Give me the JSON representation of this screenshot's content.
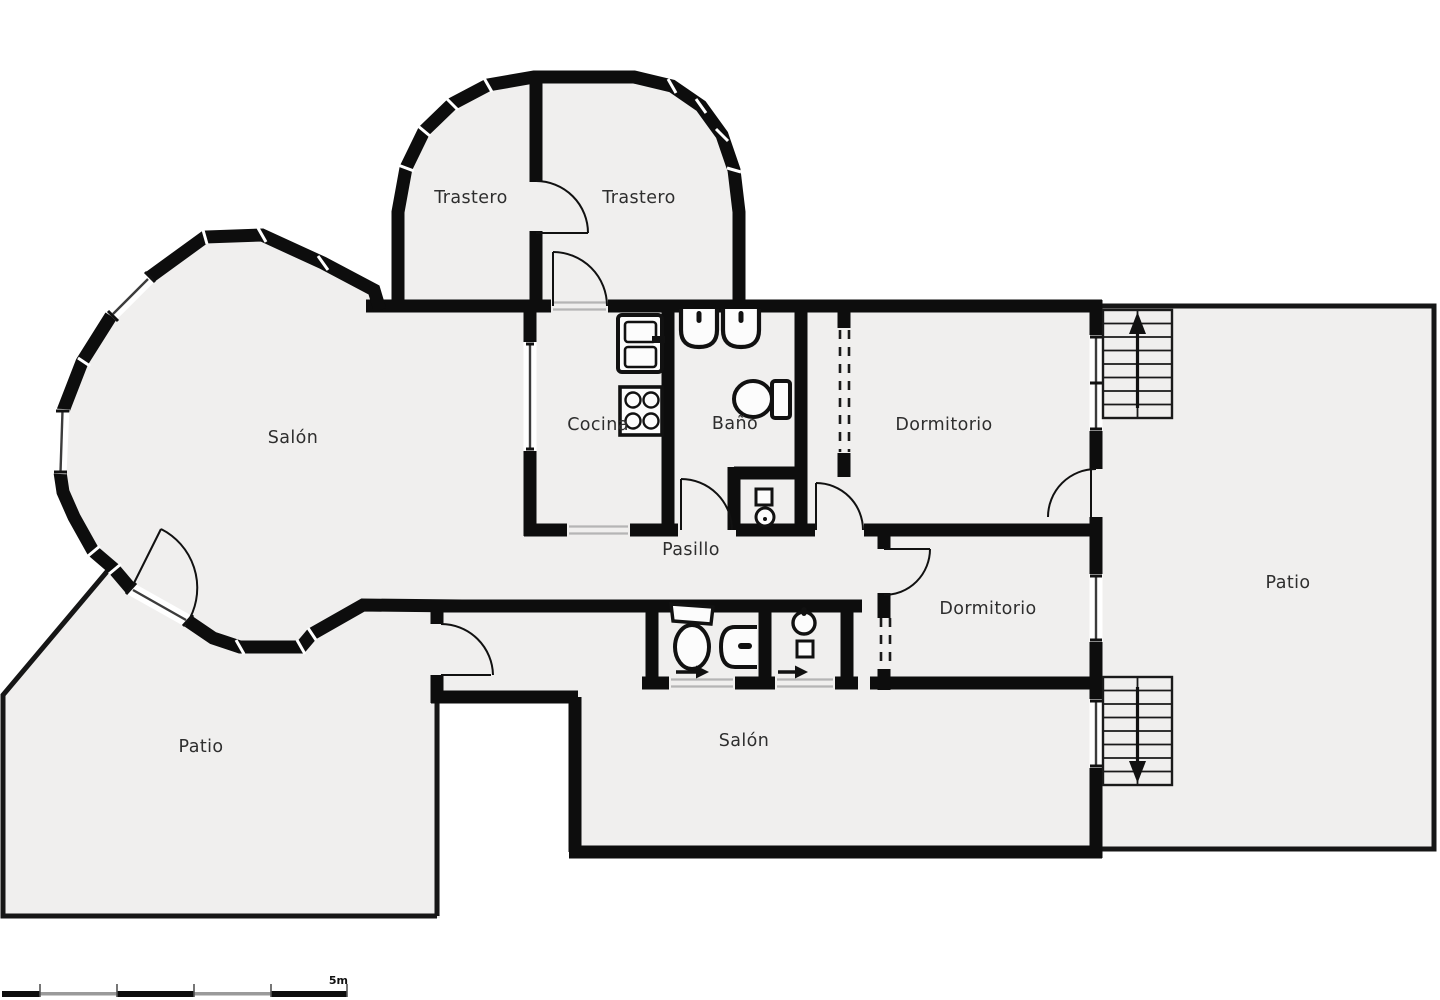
{
  "title": "Floor plan",
  "colors": {
    "wall": "#0d0d0d",
    "thin_wall": "#161616",
    "floor": "#f0efee",
    "outside": "#ffffff",
    "threshold": "#b5b5b5",
    "label": "#2e2e2e",
    "scale_gray": "#9a9a9a"
  },
  "rooms": [
    {
      "id": "trastero-left",
      "label": "Trastero"
    },
    {
      "id": "trastero-right",
      "label": "Trastero"
    },
    {
      "id": "salon-left",
      "label": "Salón"
    },
    {
      "id": "cocina",
      "label": "Cocina"
    },
    {
      "id": "bano",
      "label": "Baño"
    },
    {
      "id": "dormitorio-1",
      "label": "Dormitorio"
    },
    {
      "id": "pasillo",
      "label": "Pasillo"
    },
    {
      "id": "dormitorio-2",
      "label": "Dormitorio"
    },
    {
      "id": "patio-right",
      "label": "Patio"
    },
    {
      "id": "patio-left",
      "label": "Patio"
    },
    {
      "id": "salon-bottom",
      "label": "Salón"
    }
  ],
  "stairs": [
    {
      "id": "stairs-top-right",
      "direction": "up"
    },
    {
      "id": "stairs-bottom-right",
      "direction": "down"
    }
  ],
  "icons": [
    "fridge-icon",
    "stove-icon",
    "washbasin-icon",
    "toilet-icon",
    "shower-icon",
    "entrance-arrow-icon",
    "stairs-up-arrow-icon",
    "stairs-down-arrow-icon",
    "door-arc-icon",
    "window-icon",
    "wardrobe-dashed-icon"
  ],
  "scale_bar": {
    "label": "5m",
    "segments": 5
  }
}
